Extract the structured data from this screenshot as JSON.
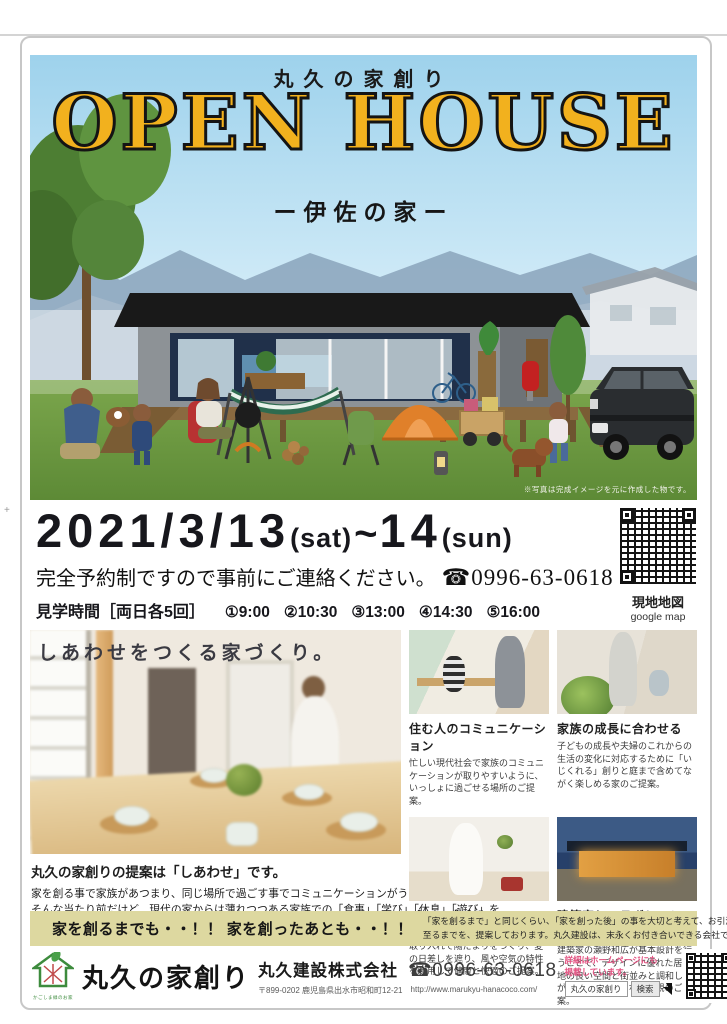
{
  "colors": {
    "title_yellow": "#f2b11e",
    "banner_khaki": "#ddd8a0",
    "accent_pink": "#e25180",
    "grass_green": "#6d9a3f",
    "sky_blue": "#a9d6ee"
  },
  "hero": {
    "brand_top": "丸久の家創り",
    "title": "OPEN HOUSE",
    "subtitle": "ー伊佐の家ー",
    "photo_note": "※写真は完成イメージを元に作成した物です。"
  },
  "event": {
    "year_date": "2021/3/13",
    "sat": "(sat)",
    "tilde": "~",
    "day2": "14",
    "sun": "(sun)",
    "reserve_note": "完全予約制ですので事前にご連絡ください。",
    "phone": "☎0996-63-0618",
    "hours_label": "見学時間［両日各5回］",
    "times": [
      "①9:00",
      "②10:30",
      "③13:00",
      "④14:30",
      "⑤16:00"
    ],
    "map_label": "現地地図",
    "map_sub": "google map"
  },
  "main": {
    "hero_caption": "しあわせをつくる家づくり。",
    "proposal_title": "丸久の家創りの提案は「しあわせ」です。",
    "proposal_line1": "家を創る事で家族があつまり、同じ場所で過ごす事でコミュニケーションがうまれ、笑顔になっていく。",
    "proposal_line2": "そんな当たり前だけど、現代の家からは薄れつつある家族での「食事」「学び」「休息」「遊び」を、",
    "proposal_line3": "一緒に考える器が「しあわせをつくる家創り」だと考えています。",
    "features": [
      {
        "title": "住む人のコミュニケーション",
        "body": "忙しい現代社会で家族のコミュニケーションが取りやすいように、いっしょに過ごせる場所のご提案。"
      },
      {
        "title": "家族の成長に合わせる",
        "body": "子どもの成長や夫婦のこれからの生活の変化に対応するために「いじくれる」創りと庭まで含めてながく楽しめる家のご提案。"
      },
      {
        "title": "パッシブデザイン",
        "body": "冬は太陽のエネルギーを積極的に取り入れて陽だまりをつくり、夏の日差しを遮り、風や空気の特性を利用して健康と快適のご提案。"
      },
      {
        "title": "建築家とコラボレーション",
        "body": "建築家の瀬野和広が基本設計を行うことで、デザインに優れた居心地の良い空間と街並みと調和しながらアクセントになる外観のご提案。"
      }
    ]
  },
  "banner": {
    "headline": "家を創るまでも・・！！ 家を創ったあとも・・！！",
    "body1": "「家を創るまで」と同じくらい、「家を創った後」の事を大切と考えて、お引渡後の保証・家計・アフターに",
    "body2": "至るまでを、提案しております。丸久建設は、末永くお付き合いできる会社です！！"
  },
  "footer": {
    "logo_caption": "かごしま緑のお家",
    "brand": "丸久の家創り",
    "company": "丸久建設株式会社",
    "phone": "☎0996-63-0618",
    "address": "〒899-0202 鹿児島県出水市昭和町12-21",
    "url": "http://www.marukyu-hanacoco.com/",
    "hp_note1": "詳細はホームページにも",
    "hp_note2": "掲載しています。",
    "search_value": "丸久の家創り",
    "search_button": "検索"
  }
}
